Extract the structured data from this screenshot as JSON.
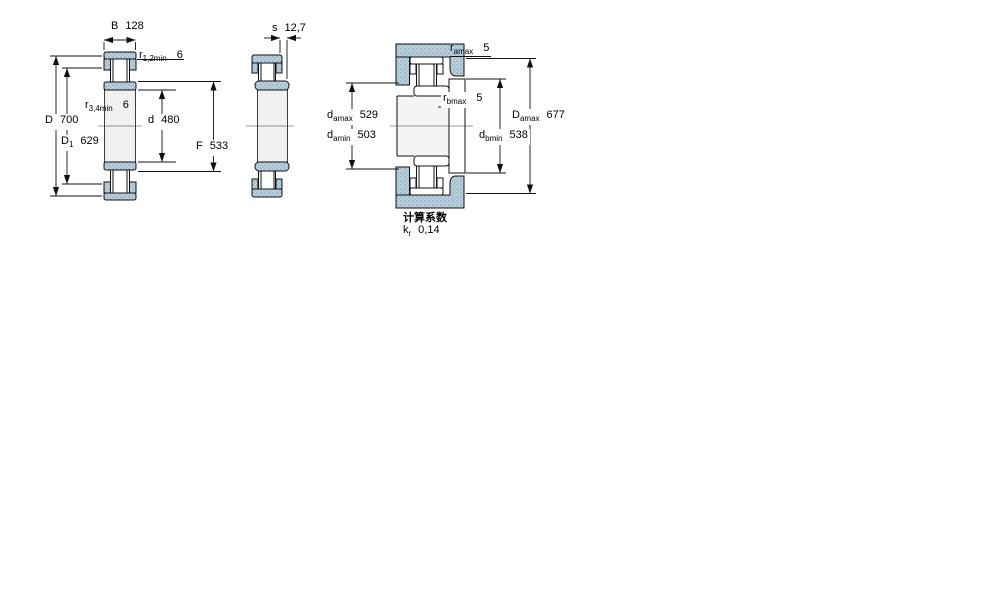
{
  "figure": {
    "heading_calc_factor": "计算系数",
    "colors": {
      "ring_fill": "#b9cedb",
      "ring_dot": "#86a9bd",
      "section_fill": "#f1f1f1",
      "line": "#111111"
    },
    "dims": {
      "B": {
        "base": "B",
        "sub": "",
        "value": "128"
      },
      "r12min": {
        "base": "r",
        "sub": "1,2min",
        "value": "6"
      },
      "r34min": {
        "base": "r",
        "sub": "3,4min",
        "value": "6"
      },
      "D": {
        "base": "D",
        "sub": "",
        "value": "700"
      },
      "D1": {
        "base": "D",
        "sub": "1",
        "value": "629"
      },
      "d": {
        "base": "d",
        "sub": "",
        "value": "480"
      },
      "F": {
        "base": "F",
        "sub": "",
        "value": "533"
      },
      "s": {
        "base": "s",
        "sub": "",
        "value": "12,7"
      },
      "ramax": {
        "base": "r",
        "sub": "amax",
        "value": "5"
      },
      "rbmax": {
        "base": "r",
        "sub": "bmax",
        "value": "5"
      },
      "damax": {
        "base": "d",
        "sub": "amax",
        "value": "529"
      },
      "damin": {
        "base": "d",
        "sub": "amin",
        "value": "503"
      },
      "dbmin": {
        "base": "d",
        "sub": "bmin",
        "value": "538"
      },
      "Damax": {
        "base": "D",
        "sub": "amax",
        "value": "677"
      },
      "kr": {
        "base": "k",
        "sub": "r",
        "value": "0,14"
      }
    }
  }
}
